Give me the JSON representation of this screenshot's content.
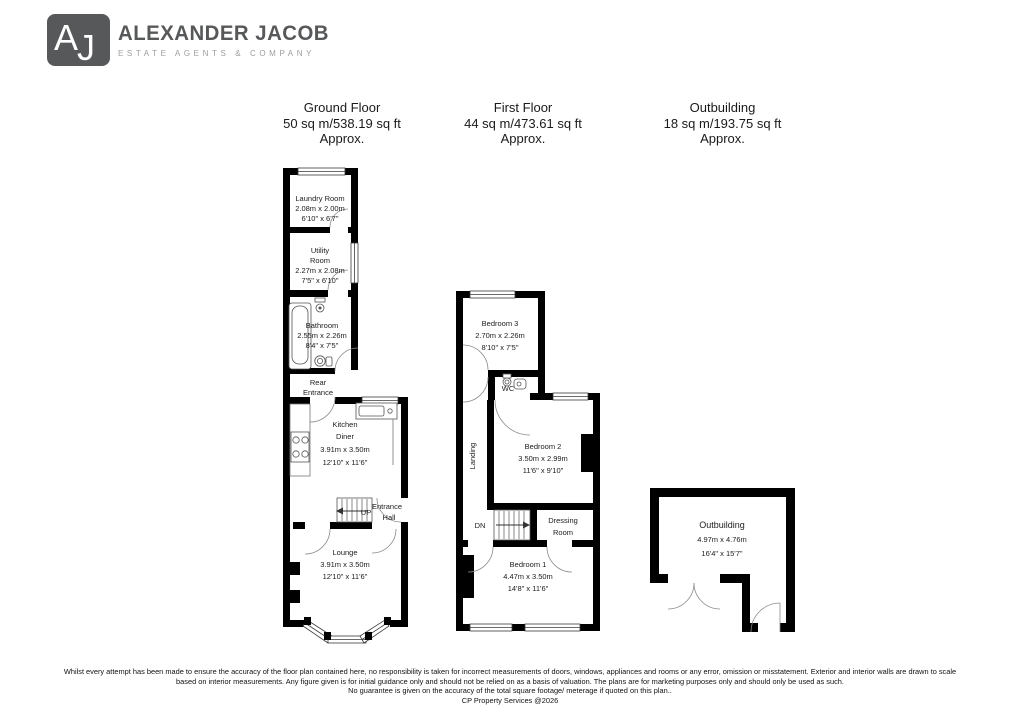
{
  "logo": {
    "monogram_a": "A",
    "monogram_j": "J",
    "name": "ALEXANDER JACOB",
    "tagline": "ESTATE AGENTS & COMPANY"
  },
  "colors": {
    "wall": "#000000",
    "logo_gray": "#57585a",
    "tagline_gray": "#9c9da0"
  },
  "floors": {
    "ground": {
      "title": "Ground Floor",
      "area": "50 sq m/538.19 sq ft",
      "approx": "Approx.",
      "rooms": {
        "laundry": {
          "name": "Laundry Room",
          "metric": "2.08m x 2.00m",
          "imperial": "6'10\" x 6'7\""
        },
        "utility": {
          "name_line1": "Utility",
          "name_line2": "Room",
          "metric": "2.27m x 2.08m",
          "imperial": "7'5\" x 6'10\""
        },
        "bathroom": {
          "name": "Bathroom",
          "metric": "2.55m x 2.26m",
          "imperial": "8'4\" x 7'5\""
        },
        "rear_entrance": {
          "name_line1": "Rear",
          "name_line2": "Entrance"
        },
        "kitchen": {
          "name_line1": "Kitchen",
          "name_line2": "Diner",
          "metric": "3.91m x 3.50m",
          "imperial": "12'10\" x 11'6\""
        },
        "entrance_hall": {
          "name_line1": "Entrance",
          "name_line2": "Hall",
          "stairs_label": "UP"
        },
        "lounge": {
          "name": "Lounge",
          "metric": "3.91m x 3.50m",
          "imperial": "12'10\" x 11'6\""
        }
      }
    },
    "first": {
      "title": "First Floor",
      "area": "44 sq m/473.61 sq ft",
      "approx": "Approx.",
      "rooms": {
        "bedroom3": {
          "name": "Bedroom 3",
          "metric": "2.70m x 2.26m",
          "imperial": "8'10\" x 7'5\""
        },
        "wc": {
          "name": "WC"
        },
        "landing": {
          "name": "Landing",
          "stairs_label": "DN"
        },
        "bedroom2": {
          "name": "Bedroom 2",
          "metric": "3.50m x 2.99m",
          "imperial": "11'6\" x 9'10\""
        },
        "dressing": {
          "name_line1": "Dressing",
          "name_line2": "Room"
        },
        "bedroom1": {
          "name": "Bedroom 1",
          "metric": "4.47m x 3.50m",
          "imperial": "14'8\" x 11'6\""
        }
      }
    },
    "outbuilding": {
      "title": "Outbuilding",
      "area": "18 sq m/193.75 sq ft",
      "approx": "Approx.",
      "rooms": {
        "outbuilding": {
          "name": "Outbuilding",
          "metric": "4.97m x 4.76m",
          "imperial": "16'4\" x 15'7\""
        }
      }
    }
  },
  "footer": {
    "line1": "Whilst every attempt has been made to ensure the accuracy of the floor plan contained here, no responsibility is taken for incorrect measurements of doors, windows, appliances and rooms or any error, omission or misstatement. Exterior and interior walls are drawn to scale",
    "line2": "based on interior measurements. Any figure given is for initial guidance only and should not be relied on as a basis of valuation. The plans are for marketing purposes only and should only be used as such.",
    "line3": "No guarantee is given on the accuracy of the total square footage/ meterage if quoted on this plan..",
    "line4": "CP Property Services @2026"
  }
}
